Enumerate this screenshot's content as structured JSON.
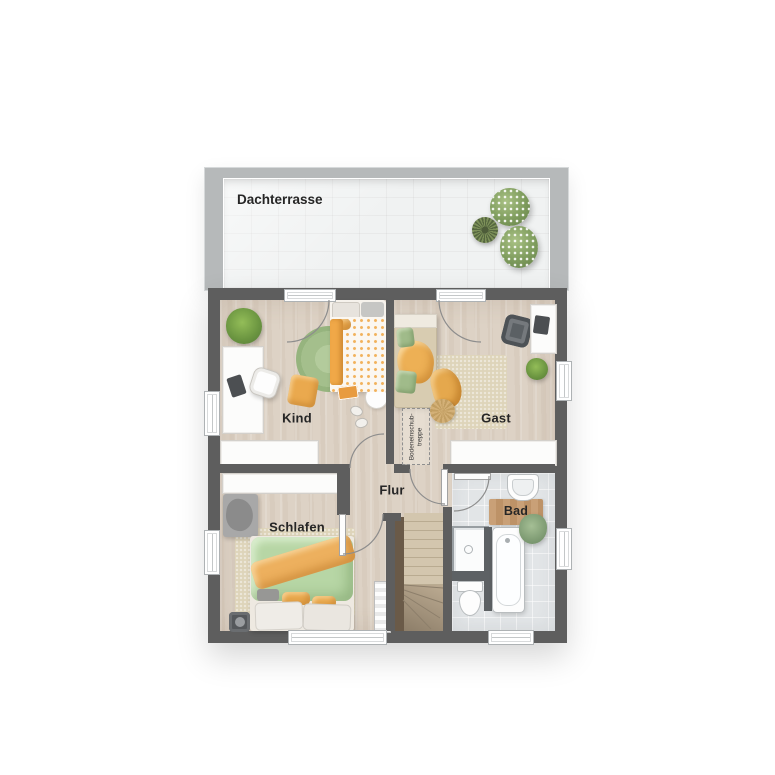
{
  "floorplan": {
    "kind": "residential-floor-plan",
    "floor": "upper-floor-with-roof-terrace",
    "labels": {
      "terrace": "Dachterrasse",
      "kind": "Kind",
      "gast": "Gast",
      "flur": "Flur",
      "schlafen": "Schlafen",
      "bad": "Bad",
      "attic_line1": "Bodeneinschub-",
      "attic_line2": "treppe"
    },
    "rooms": [
      {
        "name": "Dachterrasse",
        "type": "roof-terrace",
        "features": [
          "tiled-floor",
          "flower-bushes"
        ]
      },
      {
        "name": "Kind",
        "type": "kids-room",
        "features": [
          "bed",
          "desk",
          "desk-chair",
          "round-rug",
          "floor-pillow",
          "wardrobe",
          "plant",
          "gift-box",
          "side-table",
          "slippers"
        ]
      },
      {
        "name": "Gast",
        "type": "guest-room",
        "features": [
          "daybed",
          "rug",
          "armchair",
          "desk",
          "pouf",
          "throw-blanket",
          "sideboard",
          "plant",
          "attic-pull-down-stair-hatch"
        ]
      },
      {
        "name": "Flur",
        "type": "hallway",
        "features": [
          "staircase-down"
        ]
      },
      {
        "name": "Schlafen",
        "type": "bedroom",
        "features": [
          "double-bed",
          "rug",
          "wardrobe",
          "bench",
          "speaker",
          "radiator"
        ]
      },
      {
        "name": "Bad",
        "type": "bathroom",
        "features": [
          "shower",
          "toilet",
          "bathtub",
          "sink",
          "wooden-mat",
          "plant"
        ]
      }
    ],
    "colors": {
      "wall": "#5e5e5e",
      "terrace_wall": "#b6b9ba",
      "terrace_floor": "#f0f2f2",
      "wood_floor": "#ddd2c5",
      "bath_floor": "#e2e5e7",
      "stair_wood": "#d3c6ae",
      "stair_railing": "#6a5a48",
      "rug_green": "#a8c494",
      "rug_beige": "#ded4ba",
      "accent_orange": "#eaa94e",
      "duvet_green": "#b7d6a5",
      "furniture_white": "#fcfcfb",
      "label_text": "#262626"
    }
  }
}
